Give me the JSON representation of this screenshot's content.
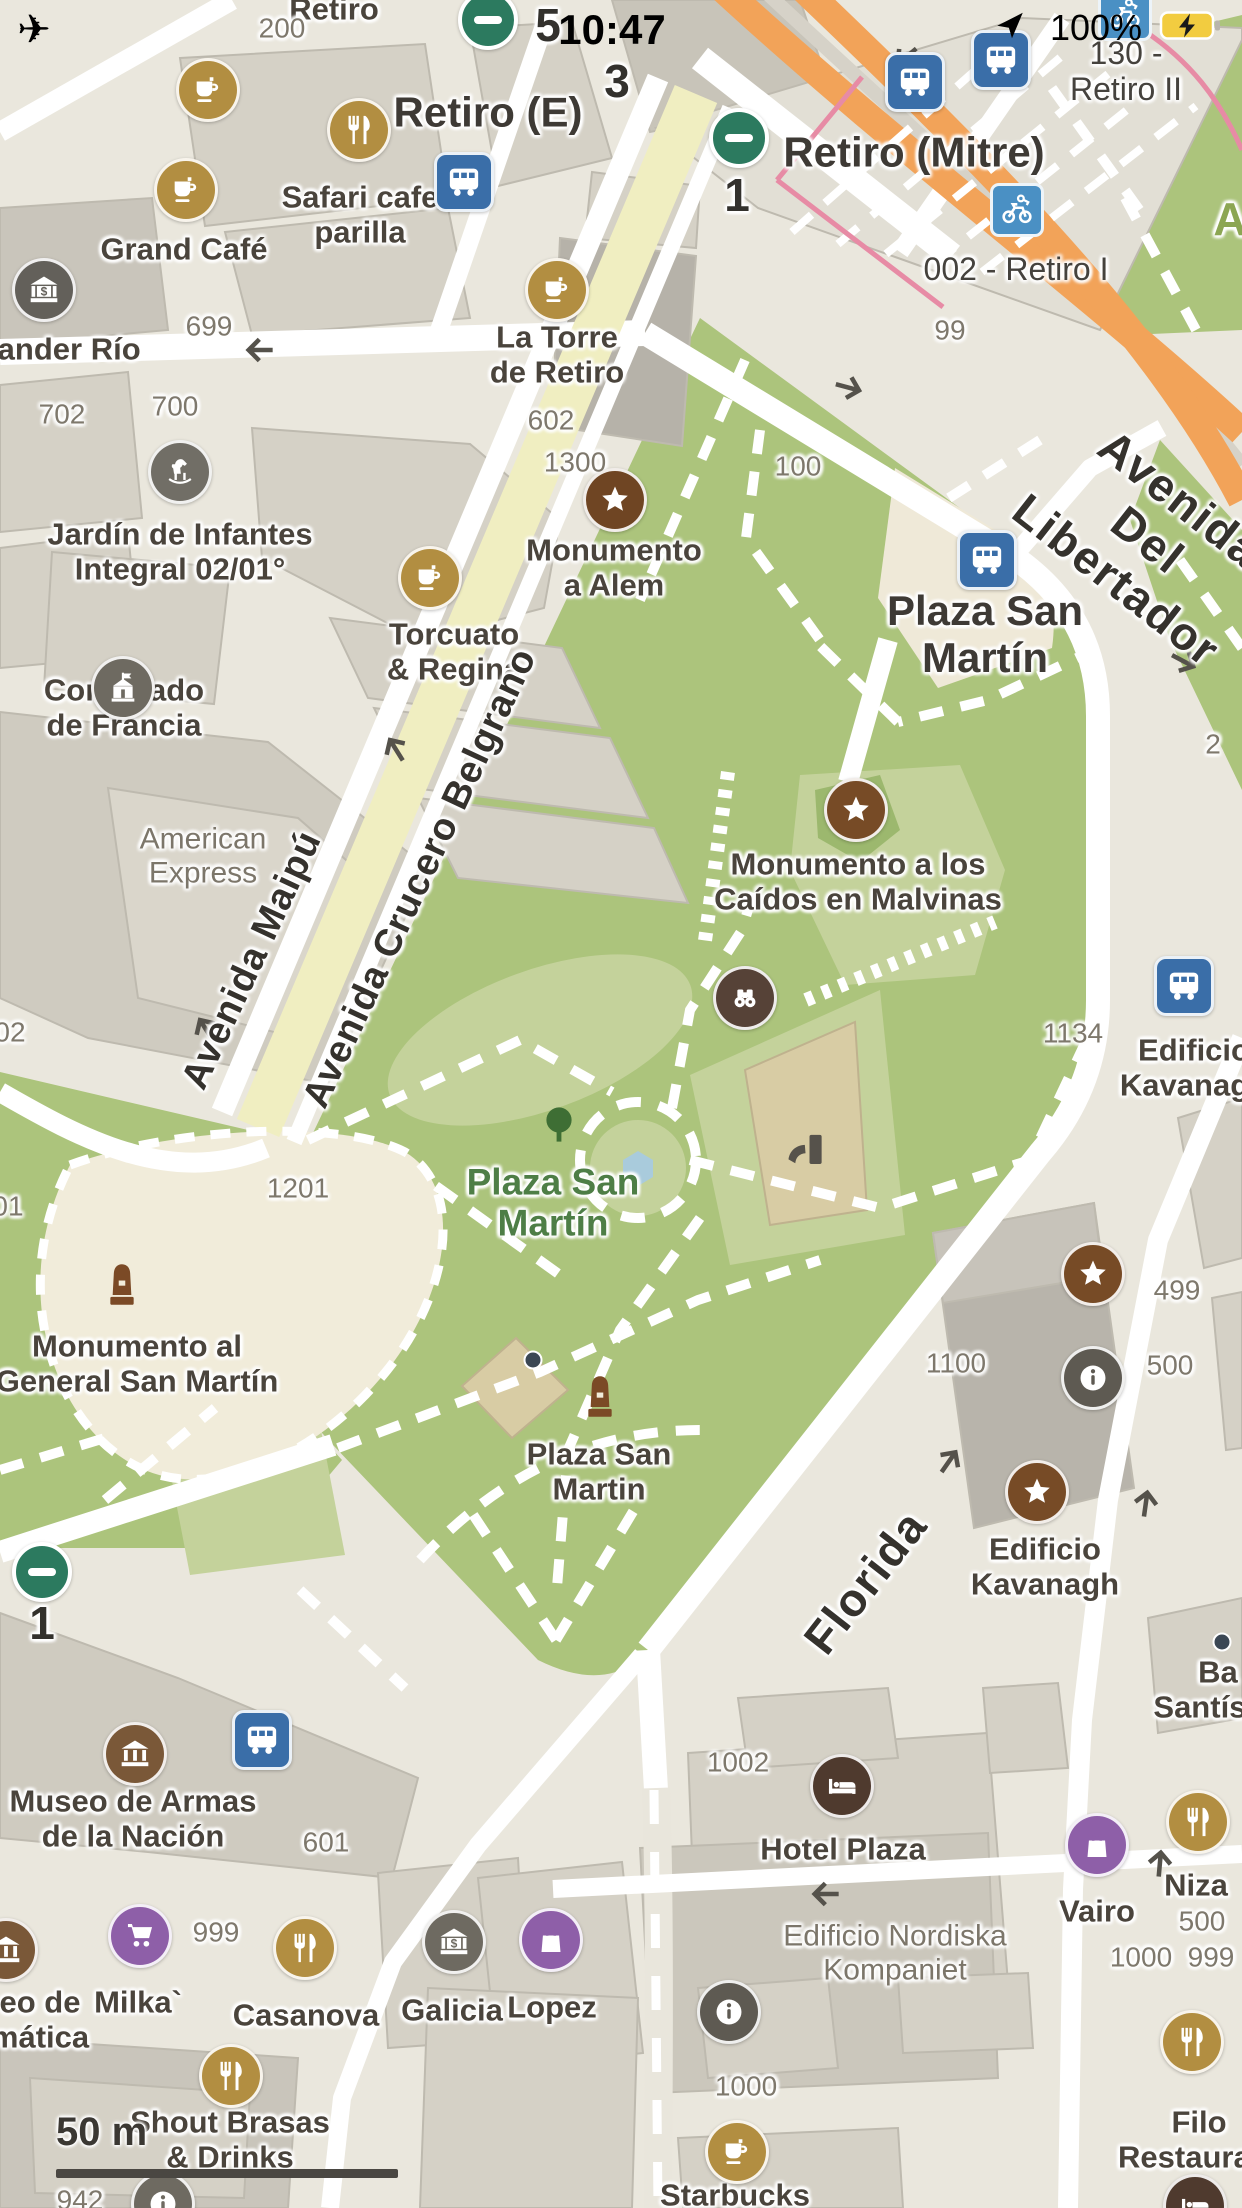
{
  "status_bar": {
    "time": "10:47",
    "battery_percent": "100%",
    "icons": [
      "airplane-icon",
      "location-arrow-icon",
      "battery-charging-icon"
    ]
  },
  "scale_bar": {
    "label": "50 m"
  },
  "colors": {
    "park_green": "#ACC47C",
    "park_light": "#C4D29B",
    "plaza_cream": "#F1ECDA",
    "avenue_orange": "#F2A359",
    "pedestrian_yellow": "#F0EEC1",
    "rail_pink": "#E78BA5",
    "bus_blue": "#3A6EA8",
    "bike_blue": "#4A90C4",
    "subway_green": "#2C7A5F",
    "poi_gold": "#B28E41",
    "poi_brown": "#774B26",
    "poi_darkbrown": "#564237",
    "poi_gray": "#6E6A61",
    "poi_purple": "#8E5FA8",
    "building_gray": "#D5D1C6"
  },
  "map": {
    "labels": [
      {
        "name": "street-label-retiro",
        "text": "Retiro",
        "x": 334,
        "y": 10,
        "cls": "poi"
      },
      {
        "name": "housenumber-200",
        "text": "200",
        "x": 282,
        "y": 28,
        "cls": "num"
      },
      {
        "name": "platform-number-5",
        "text": "5",
        "x": 548,
        "y": 26,
        "cls": "bignum"
      },
      {
        "name": "platform-number-3",
        "text": "3",
        "x": 617,
        "y": 82,
        "cls": "bignum"
      },
      {
        "name": "station-label-retiro-e",
        "text": "Retiro (E)",
        "x": 488,
        "y": 112,
        "cls": "poi-big"
      },
      {
        "name": "station-label-retiro-mitre",
        "text": "Retiro (Mitre)",
        "x": 914,
        "y": 152,
        "cls": "poi-big"
      },
      {
        "name": "bikestation-label-retiro-ii",
        "text": "130 - Retiro II",
        "x": 1126,
        "y": 72,
        "cls": "poi-sm"
      },
      {
        "name": "platform-number-1",
        "text": "1",
        "x": 737,
        "y": 196,
        "cls": "bignum"
      },
      {
        "name": "bikestation-label-retiro-i",
        "text": "002 - Retiro I",
        "x": 1016,
        "y": 270,
        "cls": "poi-sm"
      },
      {
        "name": "housenumber-99",
        "text": "99",
        "x": 950,
        "y": 330,
        "cls": "num"
      },
      {
        "name": "poi-label-safari-cafe",
        "text": "Safari cafe\nparilla",
        "x": 360,
        "y": 215,
        "cls": "poi"
      },
      {
        "name": "poi-label-grand-cafe",
        "text": "Grand Café",
        "x": 184,
        "y": 250,
        "cls": "poi"
      },
      {
        "name": "poi-label-santander-rio",
        "text": "tander Río",
        "x": 64,
        "y": 350,
        "cls": "poi"
      },
      {
        "name": "housenumber-699",
        "text": "699",
        "x": 209,
        "y": 326,
        "cls": "num"
      },
      {
        "name": "poi-label-la-torre",
        "text": "La Torre\nde Retiro",
        "x": 557,
        "y": 355,
        "cls": "poi"
      },
      {
        "name": "housenumber-702",
        "text": "702",
        "x": 62,
        "y": 414,
        "cls": "num"
      },
      {
        "name": "housenumber-700",
        "text": "700",
        "x": 175,
        "y": 406,
        "cls": "num"
      },
      {
        "name": "housenumber-602",
        "text": "602",
        "x": 551,
        "y": 420,
        "cls": "num"
      },
      {
        "name": "housenumber-1300",
        "text": "1300",
        "x": 575,
        "y": 462,
        "cls": "num"
      },
      {
        "name": "housenumber-100",
        "text": "100",
        "x": 798,
        "y": 466,
        "cls": "num"
      },
      {
        "name": "poi-label-jardin-infantes",
        "text": "Jardín de Infantes\nIntegral 02/01°",
        "x": 180,
        "y": 552,
        "cls": "poi"
      },
      {
        "name": "poi-label-monumento-alem",
        "text": "Monumento\na Alem",
        "x": 614,
        "y": 568,
        "cls": "poi"
      },
      {
        "name": "busstop-label-plaza-san-martin",
        "text": "Plaza San\nMartín",
        "x": 985,
        "y": 634,
        "cls": "poi-big"
      },
      {
        "name": "poi-label-torcuato-regina",
        "text": "Torcuato\n& Regina",
        "x": 454,
        "y": 652,
        "cls": "poi"
      },
      {
        "name": "poi-label-consulado-francia",
        "text": "Consulado\nde Francia",
        "x": 124,
        "y": 708,
        "cls": "poi"
      },
      {
        "name": "housenumber-2",
        "text": "2",
        "x": 1213,
        "y": 744,
        "cls": "num"
      },
      {
        "name": "building-label-american-express",
        "text": "American\nExpress",
        "x": 203,
        "y": 856,
        "cls": "bldg"
      },
      {
        "name": "poi-label-monumento-malvinas",
        "text": "Monumento a los\nCaídos en Malvinas",
        "x": 858,
        "y": 882,
        "cls": "poi"
      },
      {
        "name": "housenumber-1134",
        "text": "1134",
        "x": 1073,
        "y": 1033,
        "cls": "num"
      },
      {
        "name": "poi-label-edificio-kavanagh-east",
        "text": "Edificio\nKavanagh",
        "x": 1194,
        "y": 1068,
        "cls": "poi"
      },
      {
        "name": "housenumber-01",
        "text": "01",
        "x": 8,
        "y": 1206,
        "cls": "num"
      },
      {
        "name": "housenumber-02",
        "text": "02",
        "x": 10,
        "y": 1032,
        "cls": "num"
      },
      {
        "name": "housenumber-1201",
        "text": "1201",
        "x": 298,
        "y": 1188,
        "cls": "num"
      },
      {
        "name": "park-label-plaza-san-martin",
        "text": "Plaza San\nMartín",
        "x": 553,
        "y": 1203,
        "cls": "park"
      },
      {
        "name": "poi-label-monumento-general",
        "text": "Monumento al\nGeneral San Martín",
        "x": 137,
        "y": 1364,
        "cls": "poi"
      },
      {
        "name": "housenumber-1100",
        "text": "1100",
        "x": 956,
        "y": 1363,
        "cls": "num"
      },
      {
        "name": "housenumber-499",
        "text": "499",
        "x": 1177,
        "y": 1290,
        "cls": "num"
      },
      {
        "name": "housenumber-500-a",
        "text": "500",
        "x": 1170,
        "y": 1365,
        "cls": "num"
      },
      {
        "name": "poi-label-plaza-san-martin-monument",
        "text": "Plaza San\nMartin",
        "x": 599,
        "y": 1472,
        "cls": "poi"
      },
      {
        "name": "poi-label-edificio-kavanagh",
        "text": "Edificio\nKavanagh",
        "x": 1045,
        "y": 1567,
        "cls": "poi"
      },
      {
        "name": "platform-number-1-sw",
        "text": "1",
        "x": 42,
        "y": 1624,
        "cls": "bignum"
      },
      {
        "name": "poi-label-basilica-santisimo",
        "text": "Ba\nSantísim",
        "x": 1218,
        "y": 1690,
        "cls": "poi"
      },
      {
        "name": "poi-label-museo-de-armas",
        "text": "Museo de Armas\nde la Nación",
        "x": 133,
        "y": 1819,
        "cls": "poi"
      },
      {
        "name": "housenumber-601",
        "text": "601",
        "x": 326,
        "y": 1842,
        "cls": "num"
      },
      {
        "name": "housenumber-1002",
        "text": "1002",
        "x": 738,
        "y": 1762,
        "cls": "num"
      },
      {
        "name": "poi-label-hotel-plaza",
        "text": "Hotel Plaza",
        "x": 843,
        "y": 1850,
        "cls": "poi"
      },
      {
        "name": "building-label-nordiska",
        "text": "Edificio Nordiska\nKompaniet",
        "x": 895,
        "y": 1953,
        "cls": "bldg"
      },
      {
        "name": "poi-label-vairo",
        "text": "Vairo",
        "x": 1097,
        "y": 1912,
        "cls": "poi"
      },
      {
        "name": "poi-label-niza",
        "text": "Niza",
        "x": 1196,
        "y": 1886,
        "cls": "poi"
      },
      {
        "name": "housenumber-500-b",
        "text": "500",
        "x": 1202,
        "y": 1921,
        "cls": "num"
      },
      {
        "name": "housenumber-1000-a",
        "text": "1000",
        "x": 1141,
        "y": 1957,
        "cls": "num"
      },
      {
        "name": "housenumber-999-a",
        "text": "999",
        "x": 1211,
        "y": 1957,
        "cls": "num"
      },
      {
        "name": "housenumber-999-b",
        "text": "999",
        "x": 216,
        "y": 1932,
        "cls": "num"
      },
      {
        "name": "poi-label-milka",
        "text": "Milka`",
        "x": 138,
        "y": 2003,
        "cls": "poi"
      },
      {
        "name": "poi-label-casanova",
        "text": "Casanova",
        "x": 306,
        "y": 2016,
        "cls": "poi"
      },
      {
        "name": "poi-label-galicia",
        "text": "Galicia",
        "x": 452,
        "y": 2011,
        "cls": "poi"
      },
      {
        "name": "poi-label-lopez",
        "text": "Lopez",
        "x": 552,
        "y": 2008,
        "cls": "poi"
      },
      {
        "name": "poi-label-museo-informatica",
        "text": "eo de\nmática",
        "x": 40,
        "y": 2020,
        "cls": "poi"
      },
      {
        "name": "poi-label-shout-brasas",
        "text": "Shout Brasas\n& Drinks",
        "x": 230,
        "y": 2140,
        "cls": "poi"
      },
      {
        "name": "housenumber-942",
        "text": "942",
        "x": 80,
        "y": 2200,
        "cls": "num"
      },
      {
        "name": "housenumber-1000-b",
        "text": "1000",
        "x": 746,
        "y": 2086,
        "cls": "num"
      },
      {
        "name": "poi-label-starbucks",
        "text": "Starbucks",
        "x": 735,
        "y": 2196,
        "cls": "poi"
      },
      {
        "name": "poi-label-filo-restaurant",
        "text": "Filo\nRestaurant",
        "x": 1199,
        "y": 2140,
        "cls": "poi"
      },
      {
        "name": "park-label-a",
        "text": "A",
        "x": 1230,
        "y": 220,
        "cls": "park2"
      },
      {
        "name": "road-label-avenida-maipu",
        "text": "Avenida Maipú",
        "x": 252,
        "y": 960,
        "cls": "road",
        "rot": -65
      },
      {
        "name": "road-label-avenida-crucero-belgrano",
        "text": "Avenida Crucero Belgrano",
        "x": 420,
        "y": 878,
        "cls": "road",
        "rot": -65
      },
      {
        "name": "road-label-florida",
        "text": "Florida",
        "x": 866,
        "y": 1582,
        "cls": "road-big",
        "rot": -52
      },
      {
        "name": "road-label-avenida-del-libertador",
        "text": "Avenida Del Libertador",
        "x": 1148,
        "y": 540,
        "cls": "road-big",
        "rot": 38
      }
    ],
    "markers": [
      {
        "name": "subway-entrance-top",
        "icon": "subway",
        "shape": "subway",
        "x": 488,
        "y": 20
      },
      {
        "name": "subway-entrance-mitre",
        "icon": "subway",
        "shape": "subway",
        "x": 739,
        "y": 138
      },
      {
        "name": "subway-entrance-sw",
        "icon": "subway",
        "shape": "subway",
        "x": 42,
        "y": 1572
      },
      {
        "name": "bus-stop-safari",
        "icon": "bus",
        "shape": "square",
        "color": "#3A6EA8",
        "x": 464,
        "y": 182
      },
      {
        "name": "bus-stop-mitre",
        "icon": "bus",
        "shape": "square",
        "color": "#3A6EA8",
        "x": 915,
        "y": 82
      },
      {
        "name": "bus-stop-north",
        "icon": "bus",
        "shape": "square",
        "color": "#3A6EA8",
        "x": 1001,
        "y": 60
      },
      {
        "name": "bus-stop-plaza-san-martin",
        "icon": "bus",
        "shape": "square",
        "color": "#3A6EA8",
        "x": 987,
        "y": 560
      },
      {
        "name": "bus-stop-east",
        "icon": "bus",
        "shape": "square",
        "color": "#3A6EA8",
        "x": 1184,
        "y": 986
      },
      {
        "name": "bus-stop-museo",
        "icon": "bus",
        "shape": "square",
        "color": "#3A6EA8",
        "x": 262,
        "y": 1740
      },
      {
        "name": "bike-rental-retiro-i",
        "icon": "bike",
        "shape": "sq-sm",
        "color": "#4A90C4",
        "x": 1017,
        "y": 210
      },
      {
        "name": "bike-rental-retiro-ii",
        "icon": "bike",
        "shape": "sq-sm",
        "color": "#4A90C4",
        "x": 1125,
        "y": 14
      },
      {
        "name": "cafe-marker-top",
        "icon": "cafe",
        "shape": "circle",
        "color": "#B28E41",
        "x": 208,
        "y": 90
      },
      {
        "name": "cafe-marker-grand-cafe",
        "icon": "cafe",
        "shape": "circle",
        "color": "#B28E41",
        "x": 186,
        "y": 190
      },
      {
        "name": "cafe-marker-la-torre",
        "icon": "cafe",
        "shape": "circle",
        "color": "#B28E41",
        "x": 557,
        "y": 290
      },
      {
        "name": "cafe-marker-torcuato",
        "icon": "cafe",
        "shape": "circle",
        "color": "#B28E41",
        "x": 430,
        "y": 578
      },
      {
        "name": "cafe-marker-starbucks",
        "icon": "cafe",
        "shape": "circle",
        "color": "#B28E41",
        "x": 737,
        "y": 2152
      },
      {
        "name": "restaurant-marker-safari",
        "icon": "restaurant",
        "shape": "circle",
        "color": "#B28E41",
        "x": 359,
        "y": 130
      },
      {
        "name": "restaurant-marker-casanova",
        "icon": "restaurant",
        "shape": "circle",
        "color": "#B28E41",
        "x": 305,
        "y": 1948
      },
      {
        "name": "restaurant-marker-niza",
        "icon": "restaurant",
        "shape": "circle",
        "color": "#B28E41",
        "x": 1198,
        "y": 1822
      },
      {
        "name": "restaurant-marker-filo",
        "icon": "restaurant",
        "shape": "circle",
        "color": "#B28E41",
        "x": 1192,
        "y": 2042
      },
      {
        "name": "restaurant-marker-shout",
        "icon": "restaurant",
        "shape": "circle",
        "color": "#B28E41",
        "x": 231,
        "y": 2076
      },
      {
        "name": "monument-marker-alem",
        "icon": "star",
        "shape": "circle",
        "color": "#6F4523",
        "x": 615,
        "y": 500
      },
      {
        "name": "monument-marker-malvinas",
        "icon": "star",
        "shape": "circle",
        "color": "#774B26",
        "x": 856,
        "y": 810
      },
      {
        "name": "monument-marker-east",
        "icon": "star",
        "shape": "circle",
        "color": "#774B26",
        "x": 1093,
        "y": 1274
      },
      {
        "name": "monument-marker-kavanagh",
        "icon": "star",
        "shape": "circle",
        "color": "#774B26",
        "x": 1037,
        "y": 1492
      },
      {
        "name": "viewpoint-marker-binoculars",
        "icon": "binoculars",
        "shape": "circle",
        "color": "#564237",
        "x": 745,
        "y": 998
      },
      {
        "name": "obelisk-marker-general-san-martin",
        "icon": "monument",
        "shape": "plain",
        "color": "#7B4A26",
        "x": 122,
        "y": 1288,
        "s": 56
      },
      {
        "name": "obelisk-marker-plaza-san-martin",
        "icon": "monument",
        "shape": "plain",
        "color": "#7B4A26",
        "x": 600,
        "y": 1400,
        "s": 56
      },
      {
        "name": "tree-icon",
        "icon": "tree",
        "shape": "plain",
        "color": "#3E6E34",
        "x": 559,
        "y": 1126,
        "s": 48
      },
      {
        "name": "playground-slide-icon",
        "icon": "slide",
        "shape": "plain",
        "color": "#56524B",
        "x": 806,
        "y": 1150,
        "s": 56
      },
      {
        "name": "bank-marker-santander",
        "icon": "bank",
        "shape": "circle",
        "color": "#63605A",
        "x": 44,
        "y": 290
      },
      {
        "name": "bank-marker-galicia",
        "icon": "bank",
        "shape": "circle",
        "color": "#6E6A61",
        "x": 454,
        "y": 1942
      },
      {
        "name": "museum-marker-armas",
        "icon": "museum",
        "shape": "circle",
        "color": "#7A5838",
        "x": 135,
        "y": 1754
      },
      {
        "name": "museum-marker-informatica",
        "icon": "museum",
        "shape": "circle",
        "color": "#7A5838",
        "x": 6,
        "y": 1950
      },
      {
        "name": "hotel-marker-plaza",
        "icon": "bed",
        "shape": "circle",
        "color": "#4F3A2E",
        "x": 842,
        "y": 1786
      },
      {
        "name": "info-marker-east",
        "icon": "info",
        "shape": "circle",
        "color": "#5E5A52",
        "x": 1093,
        "y": 1378
      },
      {
        "name": "info-marker-south",
        "icon": "info",
        "shape": "circle",
        "color": "#5E5A52",
        "x": 729,
        "y": 2012
      },
      {
        "name": "info-marker-bottom",
        "icon": "info",
        "shape": "circle",
        "color": "#6E6A61",
        "x": 163,
        "y": 2204
      },
      {
        "name": "kindergarten-marker-horse",
        "icon": "horse",
        "shape": "circle",
        "color": "#716E66",
        "x": 180,
        "y": 472
      },
      {
        "name": "embassy-marker-consulado",
        "icon": "consulate",
        "shape": "circle",
        "color": "#6E6A61",
        "x": 123,
        "y": 688
      },
      {
        "name": "supermarket-marker-milka",
        "icon": "cart",
        "shape": "circle",
        "color": "#8E5FA8",
        "x": 140,
        "y": 1936
      },
      {
        "name": "shop-marker-vairo",
        "icon": "bag",
        "shape": "circle",
        "color": "#8E5FA8",
        "x": 1097,
        "y": 1845
      },
      {
        "name": "shop-marker-lopez",
        "icon": "bag",
        "shape": "circle",
        "color": "#8E5FA8",
        "x": 551,
        "y": 1940
      },
      {
        "name": "hotel-marker-bottom-right",
        "icon": "bed",
        "shape": "circle",
        "color": "#4F3A2E",
        "x": 1195,
        "y": 2206
      },
      {
        "name": "small-dot-building",
        "icon": "dot",
        "shape": "dot",
        "color": "#3B4754",
        "x": 533,
        "y": 1360
      },
      {
        "name": "small-dot-road",
        "icon": "dot",
        "shape": "dot",
        "color": "#3B4754",
        "x": 1222,
        "y": 1642
      }
    ],
    "arrows": [
      {
        "name": "oneway-arrow",
        "x": 258,
        "y": 350,
        "rot": 180
      },
      {
        "name": "oneway-arrow",
        "x": 850,
        "y": 388,
        "rot": 15
      },
      {
        "name": "oneway-arrow",
        "x": 1185,
        "y": 662,
        "rot": 28
      },
      {
        "name": "oneway-arrow",
        "x": 395,
        "y": 748,
        "rot": 238
      },
      {
        "name": "oneway-arrow",
        "x": 205,
        "y": 1028,
        "rot": 238
      },
      {
        "name": "oneway-arrow",
        "x": 950,
        "y": 1460,
        "rot": -55
      },
      {
        "name": "oneway-arrow",
        "x": 1146,
        "y": 1502,
        "rot": -82
      },
      {
        "name": "oneway-arrow",
        "x": 824,
        "y": 1894,
        "rot": 180
      },
      {
        "name": "oneway-arrow",
        "x": 1160,
        "y": 1862,
        "rot": -85
      },
      {
        "name": "oneway-arrow",
        "x": 905,
        "y": 58,
        "rot": 140
      }
    ]
  }
}
